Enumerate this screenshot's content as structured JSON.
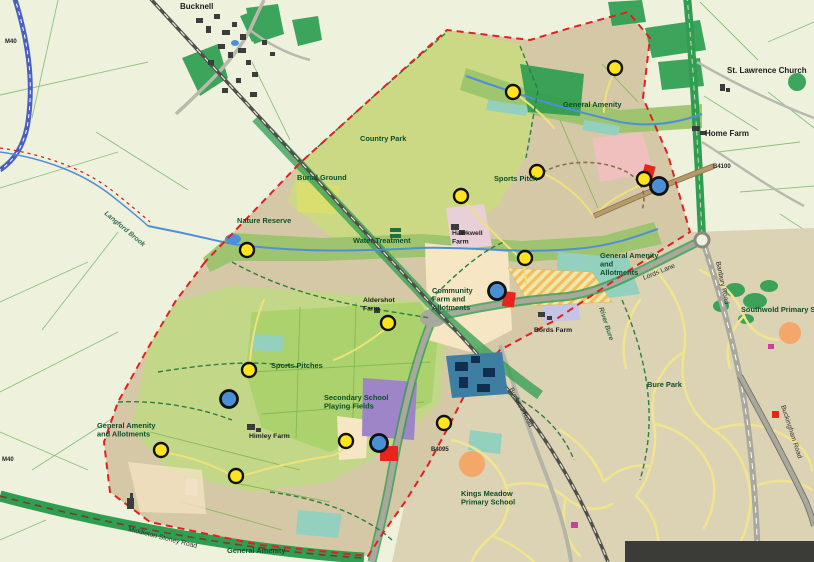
{
  "map": {
    "labels": [
      {
        "text": "Bucknell",
        "x": 180,
        "y": 9,
        "type": "place"
      },
      {
        "text": "St. Lawrence Church",
        "x": 727,
        "y": 73,
        "type": "place"
      },
      {
        "text": "Home Farm",
        "x": 705,
        "y": 136,
        "type": "place"
      },
      {
        "text": "General Amenity",
        "x": 563,
        "y": 107,
        "type": "amenity"
      },
      {
        "text": "Country Park",
        "x": 360,
        "y": 141,
        "type": "amenity"
      },
      {
        "text": "Burial Ground",
        "x": 297,
        "y": 180,
        "type": "amenity"
      },
      {
        "text": "Sports Pitch",
        "x": 494,
        "y": 181,
        "type": "amenity"
      },
      {
        "text": "Nature Reserve",
        "x": 237,
        "y": 223,
        "type": "amenity"
      },
      {
        "text": "Water Treatment",
        "x": 353,
        "y": 243,
        "type": "amenity"
      },
      {
        "text": "Hawkwell\nFarm",
        "x": 452,
        "y": 235,
        "type": "farm"
      },
      {
        "text": "Community\nFarm and\nAllotments",
        "x": 432,
        "y": 293,
        "type": "amenity"
      },
      {
        "text": "General Amenity\nand\nAllotments",
        "x": 600,
        "y": 258,
        "type": "amenity"
      },
      {
        "text": "Bords Farm",
        "x": 534,
        "y": 332,
        "type": "farm"
      },
      {
        "text": "Aldershot\nFarm",
        "x": 363,
        "y": 302,
        "type": "farm"
      },
      {
        "text": "Sports Pitches",
        "x": 271,
        "y": 368,
        "type": "amenity"
      },
      {
        "text": "Secondary School\nPlaying Fields",
        "x": 324,
        "y": 400,
        "type": "amenity"
      },
      {
        "text": "General Amenity\nand Allotments",
        "x": 97,
        "y": 428,
        "type": "amenity"
      },
      {
        "text": "Himley Farm",
        "x": 249,
        "y": 438,
        "type": "farm"
      },
      {
        "text": "Kings Meadow\nPrimary School",
        "x": 461,
        "y": 496,
        "type": "amenity"
      },
      {
        "text": "General Amenity",
        "x": 227,
        "y": 553,
        "type": "amenity"
      },
      {
        "text": "Bure Park",
        "x": 647,
        "y": 387,
        "type": "amenity"
      },
      {
        "text": "Southwold Primary School",
        "x": 741,
        "y": 312,
        "type": "amenity"
      },
      {
        "text": "Lords Lane",
        "x": 644,
        "y": 280,
        "rot": -22,
        "type": "road"
      },
      {
        "text": "Banbury Road",
        "x": 716,
        "y": 262,
        "rot": 78,
        "type": "road"
      },
      {
        "text": "Bucknell Road",
        "x": 509,
        "y": 389,
        "rot": 62,
        "type": "road"
      },
      {
        "text": "Middleton Stoney Road",
        "x": 128,
        "y": 531,
        "rot": 14,
        "type": "road"
      },
      {
        "text": "Buckingham Road",
        "x": 781,
        "y": 406,
        "rot": 72,
        "type": "road"
      },
      {
        "text": "Langford Brook",
        "x": 104,
        "y": 214,
        "rot": 40,
        "type": "water"
      },
      {
        "text": "River Bure",
        "x": 599,
        "y": 308,
        "rot": 72,
        "type": "water"
      },
      {
        "text": "B4100",
        "x": 713,
        "y": 168,
        "type": "route"
      },
      {
        "text": "B4095",
        "x": 431,
        "y": 451,
        "type": "route"
      },
      {
        "text": "M40",
        "x": 5,
        "y": 43,
        "type": "route"
      },
      {
        "text": "M40",
        "x": 2,
        "y": 461,
        "type": "route"
      }
    ],
    "markers": {
      "yellow": [
        [
          615,
          68
        ],
        [
          513,
          92
        ],
        [
          537,
          172
        ],
        [
          644,
          179
        ],
        [
          461,
          196
        ],
        [
          247,
          250
        ],
        [
          525,
          258
        ],
        [
          388,
          323
        ],
        [
          249,
          370
        ],
        [
          444,
          423
        ],
        [
          346,
          441
        ],
        [
          161,
          450
        ],
        [
          236,
          476
        ]
      ],
      "blue": [
        [
          659,
          186
        ],
        [
          497,
          291
        ],
        [
          229,
          399
        ],
        [
          379,
          443
        ]
      ]
    },
    "red_sites": [
      {
        "x": 645,
        "y": 164,
        "w": 11,
        "h": 20,
        "rot": 15
      },
      {
        "x": 504,
        "y": 291,
        "w": 12,
        "h": 15,
        "rot": 8
      },
      {
        "x": 380,
        "y": 446,
        "w": 18,
        "h": 15,
        "rot": 0
      },
      {
        "x": 772,
        "y": 411,
        "w": 7,
        "h": 7,
        "rot": 0
      }
    ],
    "colors": {
      "boundary": "#e02020",
      "marker_yellow": "#ffe41e",
      "marker_blue": "#4a8fd4",
      "site_red": "#e8251d",
      "overlay_panel": "#3b3b38"
    },
    "overlay_panel": {
      "x": 625,
      "y": 541,
      "width": 189,
      "height": 21
    }
  }
}
